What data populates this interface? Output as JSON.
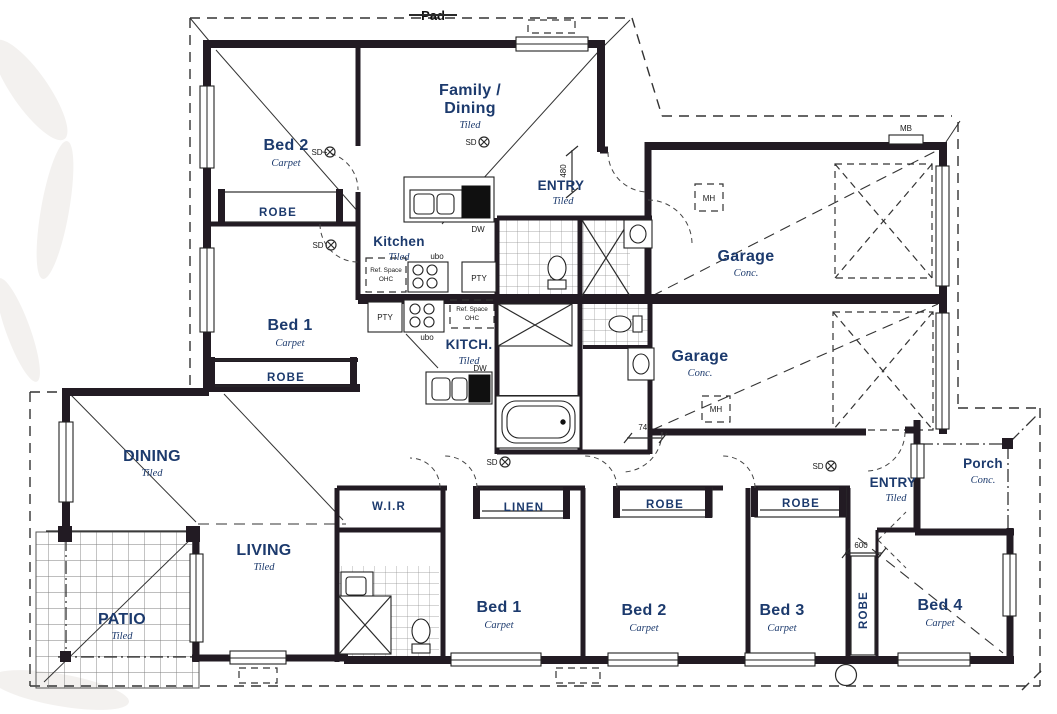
{
  "site": {
    "pad_label": "Pad"
  },
  "colors": {
    "wall": "#221b23",
    "label": "#1c3a6d",
    "annotation": "#1a1a1a",
    "line": "#2b2b2b"
  },
  "rooms": {
    "bed2_upper": {
      "name": "Bed 2",
      "finish": "Carpet"
    },
    "family_dining": {
      "name_line1": "Family /",
      "name_line2": "Dining",
      "finish": "Tiled"
    },
    "entry_upper": {
      "name": "ENTRY",
      "finish": "Tiled"
    },
    "kitchen_upper": {
      "name": "Kitchen",
      "finish": "Tiled"
    },
    "bed1_upper": {
      "name": "Bed 1",
      "finish": "Carpet"
    },
    "garage_upper": {
      "name": "Garage",
      "finish": "Conc."
    },
    "garage_lower": {
      "name": "Garage",
      "finish": "Conc."
    },
    "kitchen_lower": {
      "name": "KITCH.",
      "finish": "Tiled"
    },
    "dining_lower": {
      "name": "DINING",
      "finish": "Tiled"
    },
    "living": {
      "name": "LIVING",
      "finish": "Tiled"
    },
    "patio": {
      "name": "PATIO",
      "finish": "Tiled"
    },
    "entry_lower": {
      "name": "ENTRY",
      "finish": "Tiled"
    },
    "porch": {
      "name": "Porch",
      "finish": "Conc."
    },
    "bed1_lower": {
      "name": "Bed 1",
      "finish": "Carpet"
    },
    "bed2_lower": {
      "name": "Bed 2",
      "finish": "Carpet"
    },
    "bed3_lower": {
      "name": "Bed 3",
      "finish": "Carpet"
    },
    "bed4_lower": {
      "name": "Bed 4",
      "finish": "Carpet"
    }
  },
  "storage": {
    "robe": "ROBE",
    "linen": "LINEN",
    "wir": "W.I.R"
  },
  "fixtures": {
    "meter_box": "MB",
    "manhole": "MH",
    "smoke_detector": "SD",
    "dishwasher": "DW",
    "pantry": "PTY",
    "under_bench_oven": "ubo",
    "fridge_space_line1": "Ref. Space",
    "fridge_space_line2": "OHC"
  },
  "dimensions": {
    "entry_nib": "480",
    "garage_nib": "740",
    "entry_setback": "600"
  }
}
